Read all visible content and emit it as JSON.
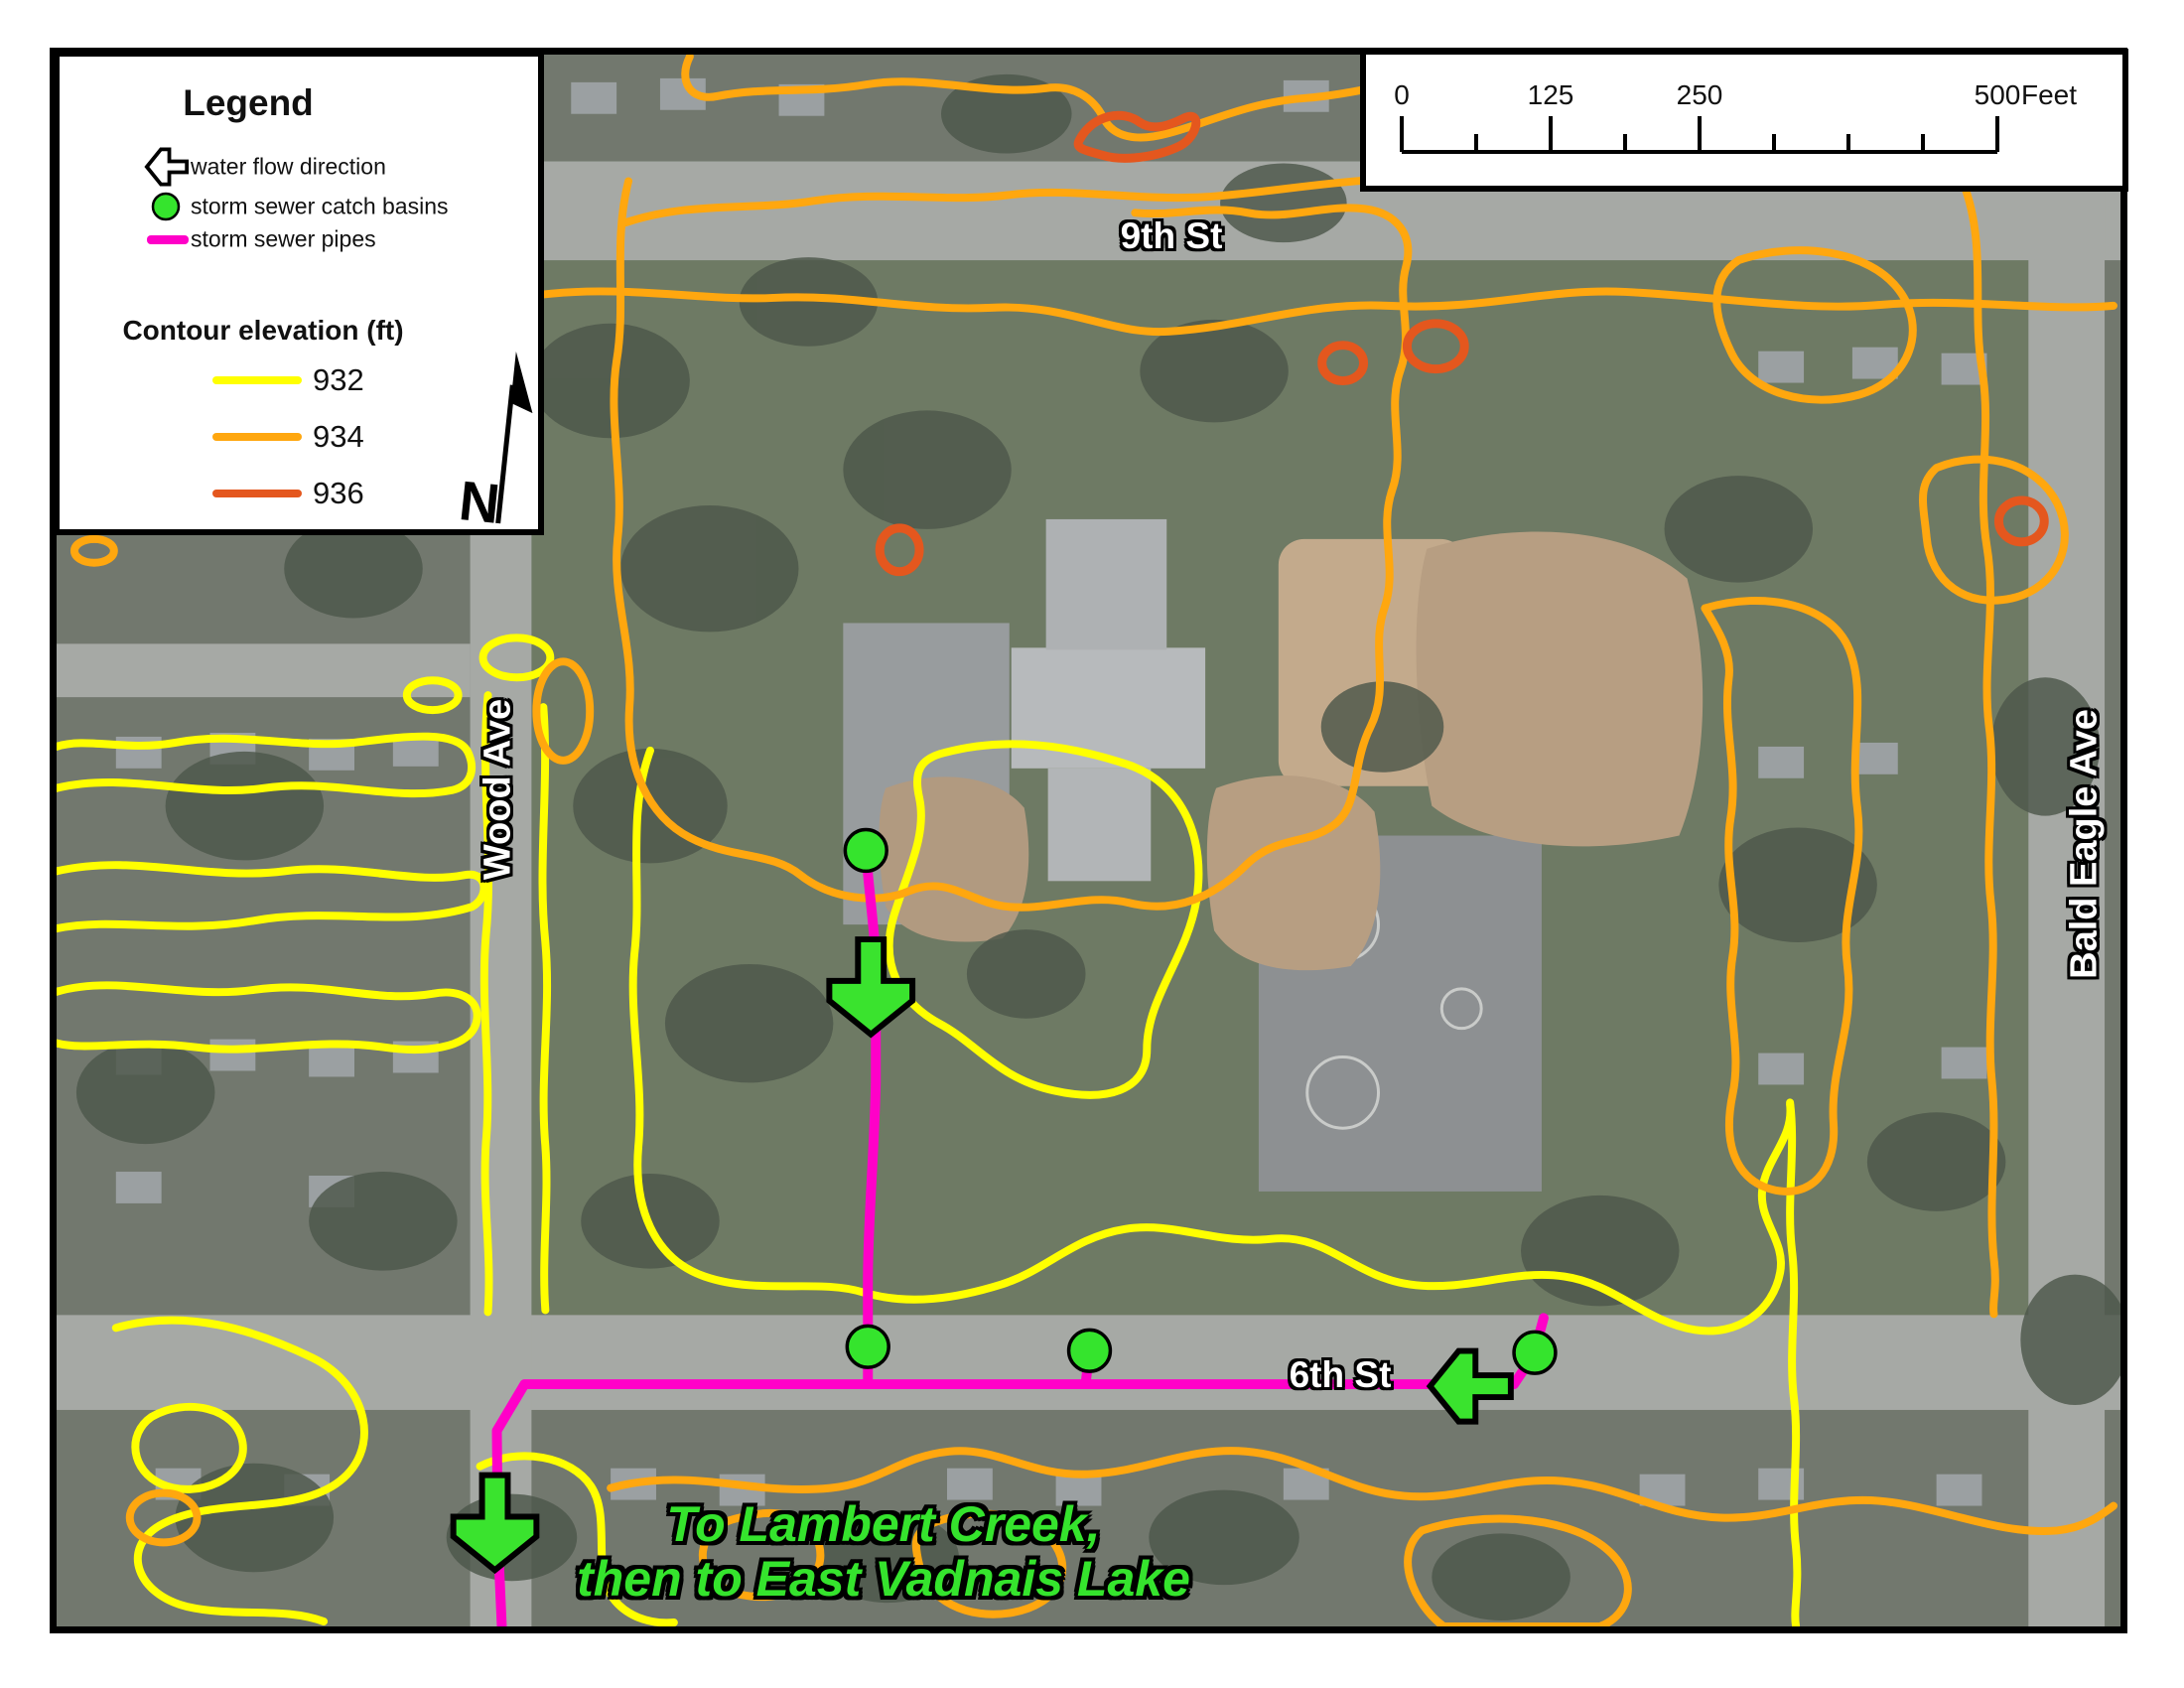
{
  "legend": {
    "title": "Legend",
    "items": [
      {
        "symbol": "flow-arrow-icon",
        "label": "water flow direction"
      },
      {
        "symbol": "catch-basin-dot",
        "label": "storm sewer catch basins",
        "color": "#35e42d"
      },
      {
        "symbol": "pipe-line",
        "label": "storm sewer pipes",
        "color": "#ff00c8"
      }
    ],
    "contour_heading": "Contour elevation (ft)",
    "contours": [
      {
        "label": "932",
        "color": "#ffff00"
      },
      {
        "label": "934",
        "color": "#ffa70f"
      },
      {
        "label": "936",
        "color": "#e4571e"
      }
    ],
    "north_label": "N"
  },
  "scale_bar": {
    "ticks": [
      "0",
      "125",
      "250",
      "500"
    ],
    "unit": "Feet"
  },
  "map": {
    "streets": {
      "top": "9th St",
      "left": "Wood Ave",
      "right": "Bald Eagle Ave",
      "bottom": "6th St"
    },
    "annotation": {
      "line1": "To Lambert Creek,",
      "line2": "then to East Vadnais Lake"
    },
    "features": {
      "catch_basin_count": 4,
      "flow_arrow_count": 3
    },
    "colors": {
      "contour_932": "#ffff00",
      "contour_934": "#ffa70f",
      "contour_936": "#e4571e",
      "pipe": "#ff00c8",
      "catch_basin": "#35e42d",
      "flow_arrow": "#3ae32e"
    }
  }
}
